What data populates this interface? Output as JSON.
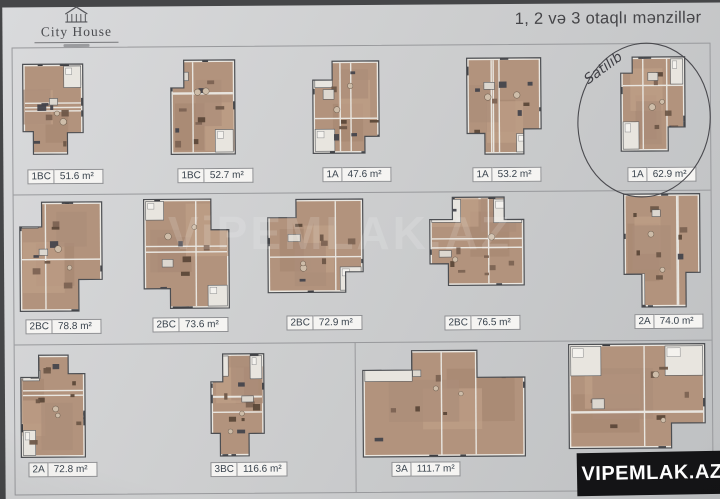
{
  "header": {
    "logo_text": "City House",
    "title": "1, 2 və 3 otaqlı mənzillər"
  },
  "plans": [
    {
      "code": "1BC",
      "area": "51.6 m²"
    },
    {
      "code": "1BC",
      "area": "52.7 m²"
    },
    {
      "code": "1A",
      "area": "47.6 m²"
    },
    {
      "code": "1A",
      "area": "53.2 m²"
    },
    {
      "code": "1A",
      "area": "62.9 m²",
      "note": "Satılıb"
    },
    {
      "code": "2BC",
      "area": "78.8 m²"
    },
    {
      "code": "2BC",
      "area": "73.6 m²"
    },
    {
      "code": "2BC",
      "area": "72.9 m²"
    },
    {
      "code": "2BC",
      "area": "76.5 m²"
    },
    {
      "code": "2A",
      "area": "74.0 m²"
    },
    {
      "code": "2A",
      "area": "72.8 m²"
    },
    {
      "code": "3BC",
      "area": "116.6 m²"
    },
    {
      "code": "3A",
      "area": "111.7 m²"
    },
    {
      "code": "3A",
      "area": "115.4 m²"
    }
  ],
  "annotations": {
    "sold_note": "Satılıb"
  },
  "watermarks": {
    "corner": "VIPEMLAK.AZ",
    "center": "ViPEMLAK.AZ"
  },
  "colors": {
    "paper": "#cdcecf",
    "floor": "#b2937d",
    "wall": "#eae7e1",
    "grid_line": "#98999c",
    "label_text": "#39434d",
    "watermark_bar": "#141416"
  }
}
